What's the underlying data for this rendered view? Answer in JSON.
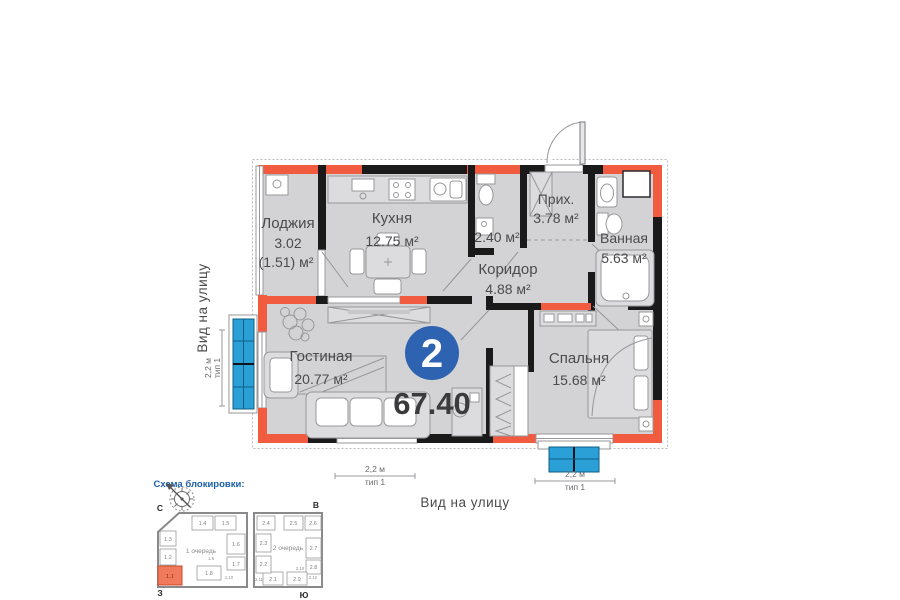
{
  "colors": {
    "accent_red": "#f15b40",
    "wall_black": "#1a1a1a",
    "floor_gray": "#d3d3d5",
    "balcony_blue": "#2ba0d7",
    "badge_blue": "#2d63b0",
    "scheme_title_blue": "#1d5fa9",
    "highlight_orange": "#ef7b5c"
  },
  "plan": {
    "badge_number": "2",
    "total_area": "67.40",
    "rooms": {
      "loggia": {
        "name": "Лоджия",
        "area": "3.02",
        "area_reduced": "(1.51) м²"
      },
      "kitchen": {
        "name": "Кухня",
        "area": "12.75 м²"
      },
      "wc": {
        "area": "2.40 м²"
      },
      "hall": {
        "name": "Прих.",
        "area": "3.78 м²"
      },
      "bathroom": {
        "name": "Ванная",
        "area": "5.63 м²"
      },
      "corridor": {
        "name": "Коридор",
        "area": "4.88 м²"
      },
      "living_room": {
        "name": "Гостиная",
        "area": "20.77 м²"
      },
      "bedroom": {
        "name": "Спальня",
        "area": "15.68 м²"
      }
    }
  },
  "street_view": {
    "left": "Вид на улицу",
    "bottom": "Вид на улицу"
  },
  "dimensions": {
    "left_balcony": {
      "size": "2,2 м",
      "type": "тип 1"
    },
    "bottom_window": {
      "size": "2,2 м",
      "type": "тип 1"
    },
    "bottom_balcony": {
      "size": "2,2 м",
      "type": "тип 1"
    }
  },
  "blocking_scheme": {
    "title": "Схема блокировки:",
    "cardinal": {
      "north": "С",
      "east": "В",
      "west": "З",
      "south": "Ю"
    },
    "phase1": {
      "label": "1 очередь",
      "units": [
        "1.1",
        "1.2",
        "1.3",
        "1.4",
        "1.5",
        "1.6",
        "1.7",
        "1.8"
      ],
      "small_units": [
        "1.9",
        "1.10"
      ],
      "highlighted_unit": "1.1"
    },
    "phase2": {
      "label": "2 очередь",
      "units": [
        "2.1",
        "2.2",
        "2.3",
        "2.4",
        "2.5",
        "2.6",
        "2.7",
        "2.8",
        "2.9"
      ],
      "small_units": [
        "2.10",
        "2.11",
        "2.12"
      ]
    }
  }
}
